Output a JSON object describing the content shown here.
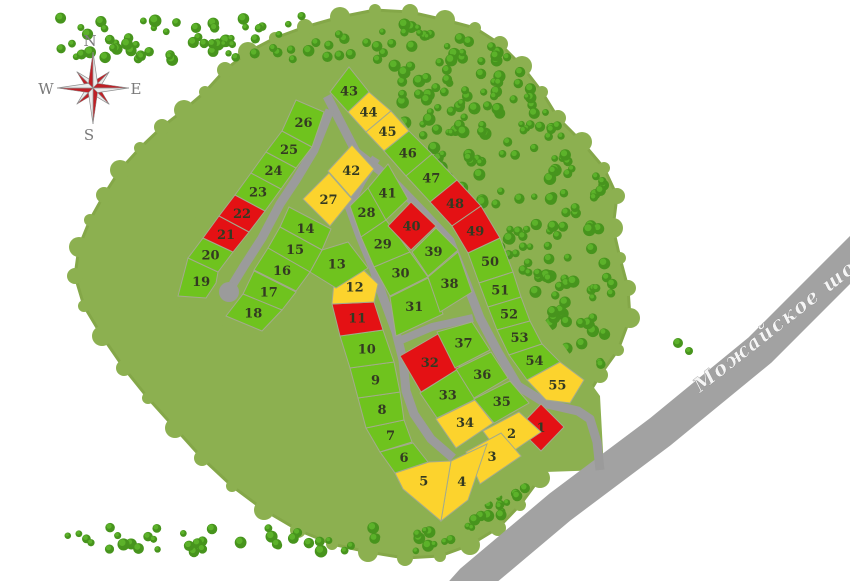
{
  "map": {
    "title_visible": false,
    "forest_outline": "205,92 225,70 248,52 275,38 305,27 340,17 375,10 410,12 445,20 475,28 500,44 522,66 542,92 558,118 582,142 604,168 617,196 613,228 620,258 628,288 630,318 618,350 600,375 585,400 575,425 560,450 540,478 520,505 498,528 470,545 440,556 405,558 368,552 332,544 298,530 264,510 232,486 202,458 175,428 148,398 124,368 102,336 84,306 75,276 79,247 90,220 104,195 120,170 140,148 162,127 184,110",
    "plot_region": "300,85 360,60 480,230 600,396 604,470 545,472 443,527 390,462 340,355 252,338 166,302 178,243 278,98",
    "stray_trees": [
      [
        678,
        343,
        5
      ],
      [
        689,
        351,
        4
      ]
    ]
  },
  "colors": {
    "g": "#6fc31e",
    "y": "#fcd32d",
    "r": "#e41114",
    "road": "#9b9b9b",
    "highway": "#a2a2a2",
    "forest_base": "#8cb050",
    "forest_edge": "#84a748",
    "tree_dark": "#47941d",
    "tree_light": "#5cb22a",
    "plot_stroke": "#a3ab8c"
  },
  "legend": {
    "status_green": "available",
    "status_yellow": "reserved",
    "status_red": "sold"
  },
  "roads": [
    {
      "d": "M327,96 L356,152 L392,180 L423,212 L450,241 L466,282 L480,318 L498,352 L518,386 L547,404 L578,411 L590,419 L597,442 L600,470",
      "w": 9
    },
    {
      "d": "M330,110 L314,150 L296,180 L280,204 L262,238 L244,266 L233,284",
      "w": 9
    },
    {
      "d": "M376,158 L361,182 L349,206 L360,236 L373,267 L383,297 L396,332 L403,360 L406,391 L414,414 L431,439 L453,458",
      "w": 9
    },
    {
      "d": "M399,341 L432,327 L473,318",
      "w": 8
    }
  ],
  "culdesac": {
    "cx": 229,
    "cy": 292,
    "r": 10
  },
  "highway": {
    "d": "M872,238 L760,350 L660,432 L560,507 L472,581 L455,600",
    "w": 34,
    "label": "Можайское шоссе",
    "label_x": 700,
    "label_y": 393,
    "label_angle": -38
  },
  "compass": {
    "cx": 93,
    "cy": 88,
    "n": "N",
    "e": "E",
    "s": "S",
    "w": "W"
  },
  "plots": [
    {
      "n": "1",
      "s": "r",
      "p": "518,428 541,404 564,427 541,451"
    },
    {
      "n": "2",
      "s": "y",
      "p": "483,431 519,412 541,432 503,458"
    },
    {
      "n": "3",
      "s": "y",
      "p": "466,452 501,433 521,456 480,484"
    },
    {
      "n": "4",
      "s": "y",
      "p": "451,461 487,444 468,500 441,521"
    },
    {
      "n": "5",
      "s": "y",
      "p": "395,473 429,462 451,461 441,521 403,489"
    },
    {
      "n": "6",
      "s": "g",
      "p": "380,452 413,443 428,462 395,473"
    },
    {
      "n": "7",
      "s": "g",
      "p": "366,428 404,420 412,442 380,452"
    },
    {
      "n": "8",
      "s": "g",
      "p": "358,398 400,392 404,420 366,428"
    },
    {
      "n": "9",
      "s": "g",
      "p": "350,368 394,362 400,392 358,398"
    },
    {
      "n": "10",
      "s": "g",
      "p": "340,336 383,330 394,362 350,368"
    },
    {
      "n": "11",
      "s": "r",
      "p": "332,304 374,302 383,330 340,336"
    },
    {
      "n": "12",
      "s": "y",
      "p": "334,282 355,262 378,284 374,302 332,304"
    },
    {
      "n": "13",
      "s": "g",
      "p": "310,272 322,250 348,242 368,268 336,288"
    },
    {
      "n": "14",
      "s": "g",
      "p": "289,207 331,229 322,250 280,227"
    },
    {
      "n": "15",
      "s": "g",
      "p": "280,227 322,250 310,272 268,248"
    },
    {
      "n": "16",
      "s": "g",
      "p": "268,248 310,272 296,291 254,270"
    },
    {
      "n": "17",
      "s": "g",
      "p": "254,271 296,292 282,310 243,294"
    },
    {
      "n": "18",
      "s": "g",
      "p": "243,294 282,310 262,331 226,316"
    },
    {
      "n": "19",
      "s": "g",
      "p": "188,258 218,272 216,283 206,298 178,296"
    },
    {
      "n": "20",
      "s": "g",
      "p": "203,238 233,252 218,272 188,258"
    },
    {
      "n": "21",
      "s": "r",
      "p": "219,216 249,232 233,252 203,238"
    },
    {
      "n": "22",
      "s": "r",
      "p": "235,195 265,211 249,232 219,216"
    },
    {
      "n": "23",
      "s": "g",
      "p": "251,173 281,189 265,211 235,195"
    },
    {
      "n": "24",
      "s": "g",
      "p": "266,152 296,168 281,189 251,173"
    },
    {
      "n": "25",
      "s": "g",
      "p": "282,131 312,147 296,168 266,152"
    },
    {
      "n": "26",
      "s": "g",
      "p": "296,100 324,112 312,147 282,131"
    },
    {
      "n": "27",
      "s": "y",
      "p": "329,173 352,199 330,226 303,199"
    },
    {
      "n": "28",
      "s": "g",
      "p": "350,206 369,187 386,220 361,237"
    },
    {
      "n": "29",
      "s": "g",
      "p": "361,237 386,220 410,252 374,267"
    },
    {
      "n": "30",
      "s": "g",
      "p": "374,267 410,252 428,277 390,296"
    },
    {
      "n": "31",
      "s": "g",
      "p": "390,297 428,278 443,314 396,336"
    },
    {
      "n": "32",
      "s": "r",
      "p": "400,356 438,334 460,368 421,392"
    },
    {
      "n": "33",
      "s": "g",
      "p": "420,393 458,369 476,399 437,418"
    },
    {
      "n": "34",
      "s": "y",
      "p": "436,419 475,400 493,423 456,448"
    },
    {
      "n": "35",
      "s": "g",
      "p": "474,399 510,381 529,403 494,423"
    },
    {
      "n": "36",
      "s": "g",
      "p": "456,369 491,352 508,378 474,398"
    },
    {
      "n": "37",
      "s": "g",
      "p": "437,332 472,322 490,350 455,368"
    },
    {
      "n": "38",
      "s": "g",
      "p": "428,277 458,252 472,292 440,312"
    },
    {
      "n": "39",
      "s": "g",
      "p": "412,252 436,228 458,250 428,276"
    },
    {
      "n": "40",
      "s": "r",
      "p": "388,226 411,202 436,226 411,250"
    },
    {
      "n": "41",
      "s": "g",
      "p": "368,188 388,164 408,199 386,220"
    },
    {
      "n": "42",
      "s": "y",
      "p": "328,171 352,145 374,169 351,197"
    },
    {
      "n": "43",
      "s": "g",
      "p": "330,92 348,112 369,92 349,67"
    },
    {
      "n": "44",
      "s": "y",
      "p": "348,112 366,132 391,111 369,92"
    },
    {
      "n": "45",
      "s": "y",
      "p": "366,132 384,151 409,131 391,111"
    },
    {
      "n": "46",
      "s": "g",
      "p": "384,151 406,176 432,154 409,131"
    },
    {
      "n": "47",
      "s": "g",
      "p": "406,176 430,202 457,180 432,154"
    },
    {
      "n": "48",
      "s": "r",
      "p": "430,202 452,226 481,206 457,180"
    },
    {
      "n": "49",
      "s": "r",
      "p": "452,226 468,253 500,238 481,206"
    },
    {
      "n": "50",
      "s": "g",
      "p": "468,253 479,283 513,272 500,238"
    },
    {
      "n": "51",
      "s": "g",
      "p": "479,283 488,307 521,297 513,272"
    },
    {
      "n": "52",
      "s": "g",
      "p": "488,307 497,330 530,321 521,297"
    },
    {
      "n": "53",
      "s": "g",
      "p": "497,330 509,355 542,344 530,321"
    },
    {
      "n": "54",
      "s": "g",
      "p": "509,355 527,380 560,362 542,344"
    },
    {
      "n": "55",
      "s": "y",
      "p": "527,380 546,400 570,403 584,380 560,362"
    }
  ]
}
